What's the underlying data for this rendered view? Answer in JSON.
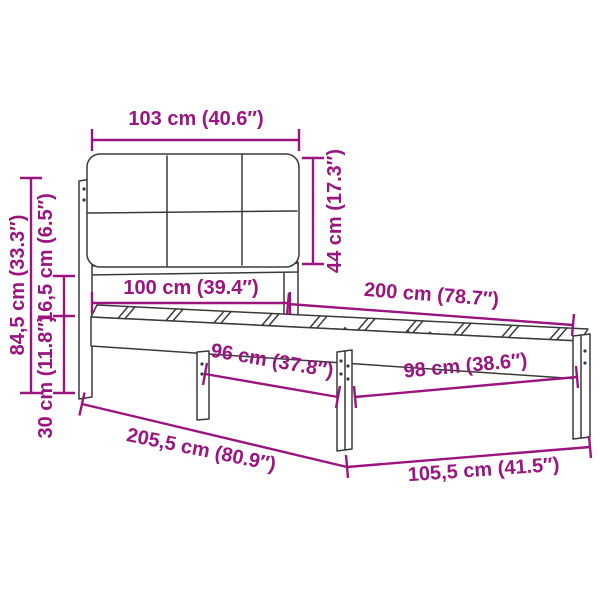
{
  "diagram": {
    "type": "bed-frame-with-upholstered-headboard-dimension-diagram",
    "background": "#ffffff",
    "colors": {
      "dimension_lines": "#9b1580",
      "line_art": "#3a3a3a"
    },
    "dimensions": {
      "headboard_width": {
        "label": "103 cm (40.6″)",
        "cm": 103,
        "inch": 40.6
      },
      "headboard_height": {
        "label": "44 cm (17.3″)",
        "cm": 44,
        "inch": 17.3
      },
      "total_height": {
        "label": "84,5 cm (33.3″)",
        "cm": 84.5,
        "inch": 33.3
      },
      "frame_height": {
        "label": "16,5 cm (6.5″)",
        "cm": 16.5,
        "inch": 6.5
      },
      "leg_height": {
        "label": "30 cm (11.8″)",
        "cm": 30,
        "inch": 11.8
      },
      "mattress_width": {
        "label": "100 cm (39.4″)",
        "cm": 100,
        "inch": 39.4
      },
      "mattress_length": {
        "label": "200 cm (78.7″)",
        "cm": 200,
        "inch": 78.7
      },
      "inner_span_96": {
        "label": "96 cm (37.8″)",
        "cm": 96,
        "inch": 37.8
      },
      "inner_span_98": {
        "label": "98 cm (38.6″)",
        "cm": 98,
        "inch": 38.6
      },
      "total_length": {
        "label": "205,5 cm (80.9″)",
        "cm": 205.5,
        "inch": 80.9
      },
      "total_width": {
        "label": "105,5 cm (41.5″)",
        "cm": 105.5,
        "inch": 41.5
      }
    }
  }
}
